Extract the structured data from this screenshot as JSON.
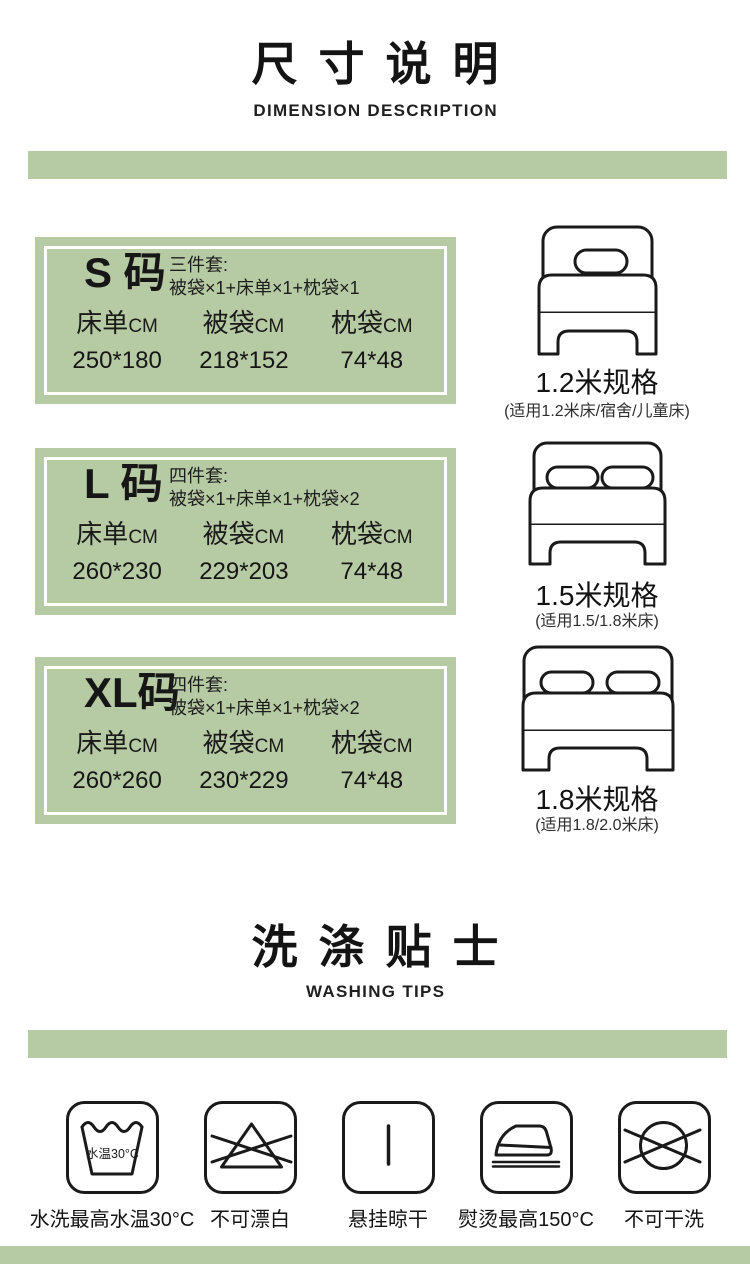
{
  "colors": {
    "accent_green": "#b6caa3",
    "ink": "#1b1b1b"
  },
  "dimension_section": {
    "title": "尺寸说明",
    "subtitle": "DIMENSION DESCRIPTION",
    "sizes": [
      {
        "size_label": "S 码",
        "set_type": "三件套:",
        "set_contents": "被袋×1+床单×1+枕袋×1",
        "columns": [
          {
            "name": "床单",
            "unit": "CM"
          },
          {
            "name": "被袋",
            "unit": "CM"
          },
          {
            "name": "枕袋",
            "unit": "CM"
          }
        ],
        "values": [
          "250*180",
          "218*152",
          "74*48"
        ],
        "bed_icon": "single-bed-icon",
        "bed_spec": "1.2米规格",
        "bed_applicable": "(适用1.2米床/宿舍/儿童床)"
      },
      {
        "size_label": "L 码",
        "set_type": "四件套:",
        "set_contents": "被袋×1+床单×1+枕袋×2",
        "columns": [
          {
            "name": "床单",
            "unit": "CM"
          },
          {
            "name": "被袋",
            "unit": "CM"
          },
          {
            "name": "枕袋",
            "unit": "CM"
          }
        ],
        "values": [
          "260*230",
          "229*203",
          "74*48"
        ],
        "bed_icon": "double-bed-icon",
        "bed_spec": "1.5米规格",
        "bed_applicable": "(适用1.5/1.8米床)"
      },
      {
        "size_label": "XL码",
        "set_type": "四件套:",
        "set_contents": "被袋×1+床单×1+枕袋×2",
        "columns": [
          {
            "name": "床单",
            "unit": "CM"
          },
          {
            "name": "被袋",
            "unit": "CM"
          },
          {
            "name": "枕袋",
            "unit": "CM"
          }
        ],
        "values": [
          "260*260",
          "230*229",
          "74*48"
        ],
        "bed_icon": "wide-bed-icon",
        "bed_spec": "1.8米规格",
        "bed_applicable": "(适用1.8/2.0米床)"
      }
    ]
  },
  "washing_section": {
    "title": "洗涤贴士",
    "subtitle": "WASHING TIPS",
    "tips": [
      {
        "icon": "wash-tub-30-icon",
        "icon_text": "水温30°C",
        "label": "水洗最高水温30°C"
      },
      {
        "icon": "no-bleach-icon",
        "label": "不可漂白"
      },
      {
        "icon": "hang-dry-icon",
        "label": "悬挂晾干"
      },
      {
        "icon": "iron-max-150-icon",
        "label": "熨烫最高150°C"
      },
      {
        "icon": "no-dry-clean-icon",
        "label": "不可干洗"
      }
    ]
  }
}
